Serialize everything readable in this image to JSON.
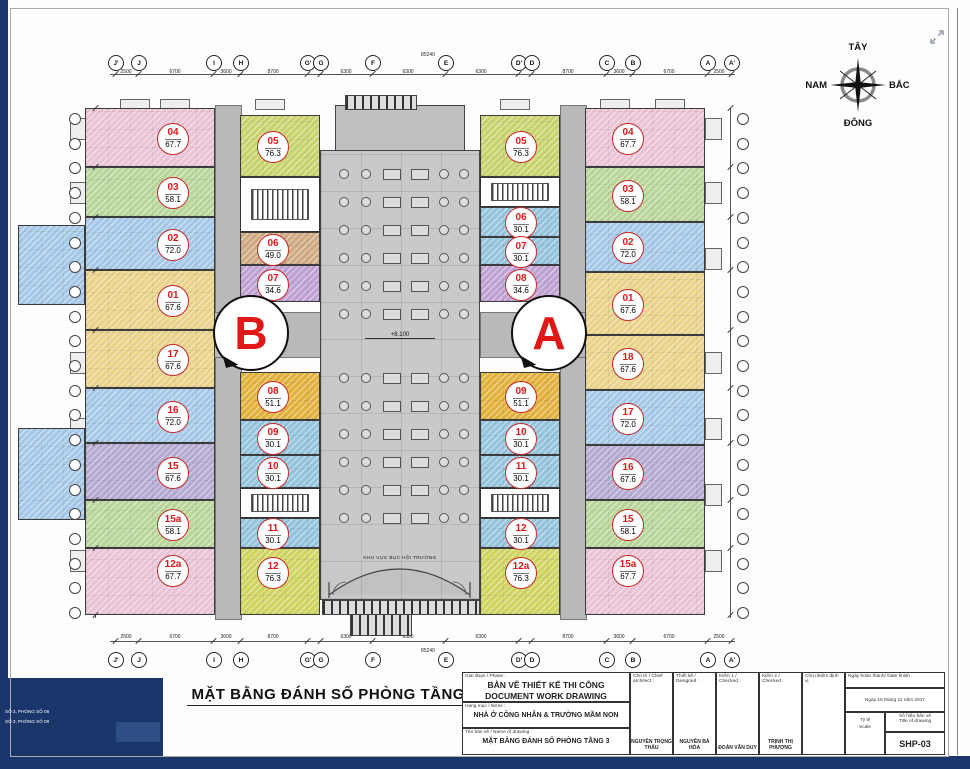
{
  "viewer": {
    "corner_notes": [
      "SỐ 3, PHÒNG SỐ 08",
      "SỐ 3, PHÒNG SỐ 09"
    ]
  },
  "compass": {
    "top": "TÂY",
    "left": "NAM",
    "right": "BẮC",
    "bottom": "ĐÔNG"
  },
  "plan": {
    "title": "MẶT BẰNG ĐÁNH SỐ PHÒNG TẦNG 3",
    "elevation": "+8.100",
    "stage_label": "KHU VỰC BỤC HỘI TRƯỜNG",
    "marker_a": "A",
    "marker_b": "B",
    "dim_total": "85240",
    "grid_letters": [
      "J'",
      "J",
      "I",
      "H",
      "G'",
      "G",
      "F",
      "E",
      "D'",
      "D",
      "C",
      "B",
      "A",
      "A'"
    ],
    "grid_letter_x": [
      115,
      138,
      213,
      240,
      307,
      320,
      372,
      445,
      518,
      531,
      606,
      632,
      707,
      731
    ],
    "dim_segments": [
      {
        "x": 126,
        "t": "2500"
      },
      {
        "x": 175,
        "t": "6700"
      },
      {
        "x": 226,
        "t": "3600"
      },
      {
        "x": 273,
        "t": "8700"
      },
      {
        "x": 346,
        "t": "6300"
      },
      {
        "x": 408,
        "t": "6300"
      },
      {
        "x": 481,
        "t": "6300"
      },
      {
        "x": 568,
        "t": "8700"
      },
      {
        "x": 619,
        "t": "3600"
      },
      {
        "x": 669,
        "t": "6700"
      },
      {
        "x": 719,
        "t": "2500"
      }
    ],
    "colors": {
      "pink": "#eac4d6",
      "green": "#b9d69a",
      "blue": "#a6c8e8",
      "yellow": "#e9d289",
      "purple": "#b4aad2",
      "olive": "#c9d36e",
      "brown": "#cfa981",
      "purple2": "#bfa0d2",
      "gold": "#e2b13c",
      "lblue": "#93c3dd",
      "ygreen": "#ced45f",
      "corridor": "#b9b9b9",
      "navy": "#1a366b",
      "badge_red": "#e01818"
    },
    "units": [
      {
        "block": "B",
        "no": "04",
        "area": "67.7",
        "color": "pink",
        "x": 85,
        "y": 108,
        "w": 130,
        "h": 59,
        "bx": 22
      },
      {
        "block": "B",
        "no": "03",
        "area": "58.1",
        "color": "green",
        "x": 85,
        "y": 167,
        "w": 130,
        "h": 50,
        "bx": 22
      },
      {
        "block": "B",
        "no": "02",
        "area": "72.0",
        "color": "blue",
        "x": 85,
        "y": 217,
        "w": 130,
        "h": 53,
        "bx": 22
      },
      {
        "block": "B",
        "no": "01",
        "area": "67.6",
        "color": "yellow",
        "x": 85,
        "y": 270,
        "w": 130,
        "h": 60,
        "bx": 22
      },
      {
        "block": "B",
        "no": "17",
        "area": "67.6",
        "color": "yellow",
        "x": 85,
        "y": 330,
        "w": 130,
        "h": 58,
        "bx": 22
      },
      {
        "block": "B",
        "no": "16",
        "area": "72.0",
        "color": "blue",
        "x": 85,
        "y": 388,
        "w": 130,
        "h": 55,
        "bx": 22
      },
      {
        "block": "B",
        "no": "15",
        "area": "67.6",
        "color": "purple",
        "x": 85,
        "y": 443,
        "w": 130,
        "h": 57,
        "bx": 22
      },
      {
        "block": "B",
        "no": "15a",
        "area": "58.1",
        "color": "green",
        "x": 85,
        "y": 500,
        "w": 130,
        "h": 48,
        "bx": 22
      },
      {
        "block": "B",
        "no": "12a",
        "area": "67.7",
        "color": "pink",
        "x": 85,
        "y": 548,
        "w": 130,
        "h": 67,
        "bx": 22,
        "by": -12
      },
      {
        "block": "B",
        "no": "05",
        "area": "76.3",
        "color": "olive",
        "x": 240,
        "y": 115,
        "w": 80,
        "h": 62,
        "bx": -8
      },
      {
        "block": "B",
        "no": "06",
        "area": "49.0",
        "color": "brown",
        "x": 240,
        "y": 232,
        "w": 80,
        "h": 33,
        "bx": -8
      },
      {
        "block": "B",
        "no": "07",
        "area": "34.6",
        "color": "purple2",
        "x": 240,
        "y": 265,
        "w": 80,
        "h": 37,
        "bx": -8
      },
      {
        "block": "B",
        "no": "08",
        "area": "51.1",
        "color": "gold",
        "x": 240,
        "y": 372,
        "w": 80,
        "h": 48,
        "bx": -8
      },
      {
        "block": "B",
        "no": "09",
        "area": "30.1",
        "color": "lblue",
        "x": 240,
        "y": 420,
        "w": 80,
        "h": 35,
        "bx": -8
      },
      {
        "block": "B",
        "no": "10",
        "area": "30.1",
        "color": "lblue",
        "x": 240,
        "y": 455,
        "w": 80,
        "h": 33,
        "bx": -8
      },
      {
        "block": "B",
        "no": "11",
        "area": "30.1",
        "color": "lblue",
        "x": 240,
        "y": 518,
        "w": 80,
        "h": 30,
        "bx": -8
      },
      {
        "block": "B",
        "no": "12",
        "area": "76.3",
        "color": "ygreen",
        "x": 240,
        "y": 548,
        "w": 80,
        "h": 67,
        "bx": -8,
        "by": -10
      },
      {
        "block": "A",
        "no": "05",
        "area": "76.3",
        "color": "olive",
        "x": 480,
        "y": 115,
        "w": 80,
        "h": 62
      },
      {
        "block": "A",
        "no": "06",
        "area": "30.1",
        "color": "lblue",
        "x": 480,
        "y": 207,
        "w": 80,
        "h": 30
      },
      {
        "block": "A",
        "no": "07",
        "area": "30.1",
        "color": "lblue",
        "x": 480,
        "y": 237,
        "w": 80,
        "h": 28
      },
      {
        "block": "A",
        "no": "08",
        "area": "34.6",
        "color": "purple2",
        "x": 480,
        "y": 265,
        "w": 80,
        "h": 37
      },
      {
        "block": "A",
        "no": "09",
        "area": "51.1",
        "color": "gold",
        "x": 480,
        "y": 372,
        "w": 80,
        "h": 48
      },
      {
        "block": "A",
        "no": "10",
        "area": "30.1",
        "color": "lblue",
        "x": 480,
        "y": 420,
        "w": 80,
        "h": 35
      },
      {
        "block": "A",
        "no": "11",
        "area": "30.1",
        "color": "lblue",
        "x": 480,
        "y": 455,
        "w": 80,
        "h": 33
      },
      {
        "block": "A",
        "no": "12",
        "area": "30.1",
        "color": "lblue",
        "x": 480,
        "y": 518,
        "w": 80,
        "h": 30
      },
      {
        "block": "A",
        "no": "12a",
        "area": "76.3",
        "color": "ygreen",
        "x": 480,
        "y": 548,
        "w": 80,
        "h": 67,
        "by": -10
      },
      {
        "block": "A",
        "no": "04",
        "area": "67.7",
        "color": "pink",
        "x": 585,
        "y": 108,
        "w": 120,
        "h": 59,
        "bx": -18
      },
      {
        "block": "A",
        "no": "03",
        "area": "58.1",
        "color": "green",
        "x": 585,
        "y": 167,
        "w": 120,
        "h": 55,
        "bx": -18
      },
      {
        "block": "A",
        "no": "02",
        "area": "72.0",
        "color": "blue",
        "x": 585,
        "y": 222,
        "w": 120,
        "h": 50,
        "bx": -18
      },
      {
        "block": "A",
        "no": "01",
        "area": "67.6",
        "color": "yellow",
        "x": 585,
        "y": 272,
        "w": 120,
        "h": 63,
        "bx": -18
      },
      {
        "block": "A",
        "no": "18",
        "area": "67.6",
        "color": "yellow",
        "x": 585,
        "y": 335,
        "w": 120,
        "h": 55,
        "bx": -18
      },
      {
        "block": "A",
        "no": "17",
        "area": "72.0",
        "color": "blue",
        "x": 585,
        "y": 390,
        "w": 120,
        "h": 55,
        "bx": -18
      },
      {
        "block": "A",
        "no": "16",
        "area": "67.6",
        "color": "purple",
        "x": 585,
        "y": 445,
        "w": 120,
        "h": 55,
        "bx": -18
      },
      {
        "block": "A",
        "no": "15",
        "area": "58.1",
        "color": "green",
        "x": 585,
        "y": 500,
        "w": 120,
        "h": 48,
        "bx": -18
      },
      {
        "block": "A",
        "no": "15a",
        "area": "67.7",
        "color": "pink",
        "x": 585,
        "y": 548,
        "w": 120,
        "h": 67,
        "bx": -18,
        "by": -12
      }
    ],
    "corridors": [
      {
        "x": 215,
        "y": 105,
        "w": 25,
        "h": 513
      },
      {
        "x": 560,
        "y": 105,
        "w": 25,
        "h": 513
      },
      {
        "x": 195,
        "y": 312,
        "w": 125,
        "h": 44
      },
      {
        "x": 480,
        "y": 312,
        "w": 130,
        "h": 44
      }
    ],
    "cores": [
      {
        "x": 240,
        "y": 177,
        "w": 80,
        "h": 55
      },
      {
        "x": 240,
        "y": 488,
        "w": 80,
        "h": 30
      },
      {
        "x": 480,
        "y": 177,
        "w": 80,
        "h": 30
      },
      {
        "x": 480,
        "y": 488,
        "w": 80,
        "h": 30
      }
    ],
    "protrusions": [
      {
        "x": 18,
        "y": 225,
        "w": 67,
        "h": 80,
        "color": "blue"
      },
      {
        "x": 18,
        "y": 428,
        "w": 67,
        "h": 92,
        "color": "blue"
      }
    ]
  },
  "titleblock": {
    "phase_label": "Giai đoạn / Phase :",
    "phase_line1": "BẢN VẼ THIẾT KẾ THI CÔNG",
    "phase_line2": "DOCUMENT WORK DRAWING",
    "items_label": "Hạng mục / Items :",
    "items_value": "NHÀ Ở CÔNG NHÂN & TRƯỜNG MẦM NON",
    "name_label": "Tên bản vẽ / Name of drawing :",
    "name_value": "MẶT BẰNG ĐÁNH SỐ PHÒNG TẦNG 3",
    "sig_headers": [
      "Chủ trì / Chief architect :",
      "Thiết kế / Designed :",
      "Kiểm 1 / Checked :",
      "Kiểm 2 / Checked :",
      "Chủ nhiệm định vị"
    ],
    "sig_names": [
      "NGUYỄN TRỌNG THẤU",
      "NGUYỄN BÁ HÒA",
      "ĐOÀN VĂN DUY",
      "TRỊNH THỊ PHƯỢNG",
      ""
    ],
    "date_label": "Ngày hoàn thành/ Date finish :",
    "date_value": "Ngày 16 tháng 11 năm 2017",
    "scale_label1": "Tỷ lệ",
    "scale_label2": "Scale",
    "number_label1": "Số hiệu bản vẽ",
    "number_label2": "Title of drawing",
    "number_value": "SHP-03"
  }
}
